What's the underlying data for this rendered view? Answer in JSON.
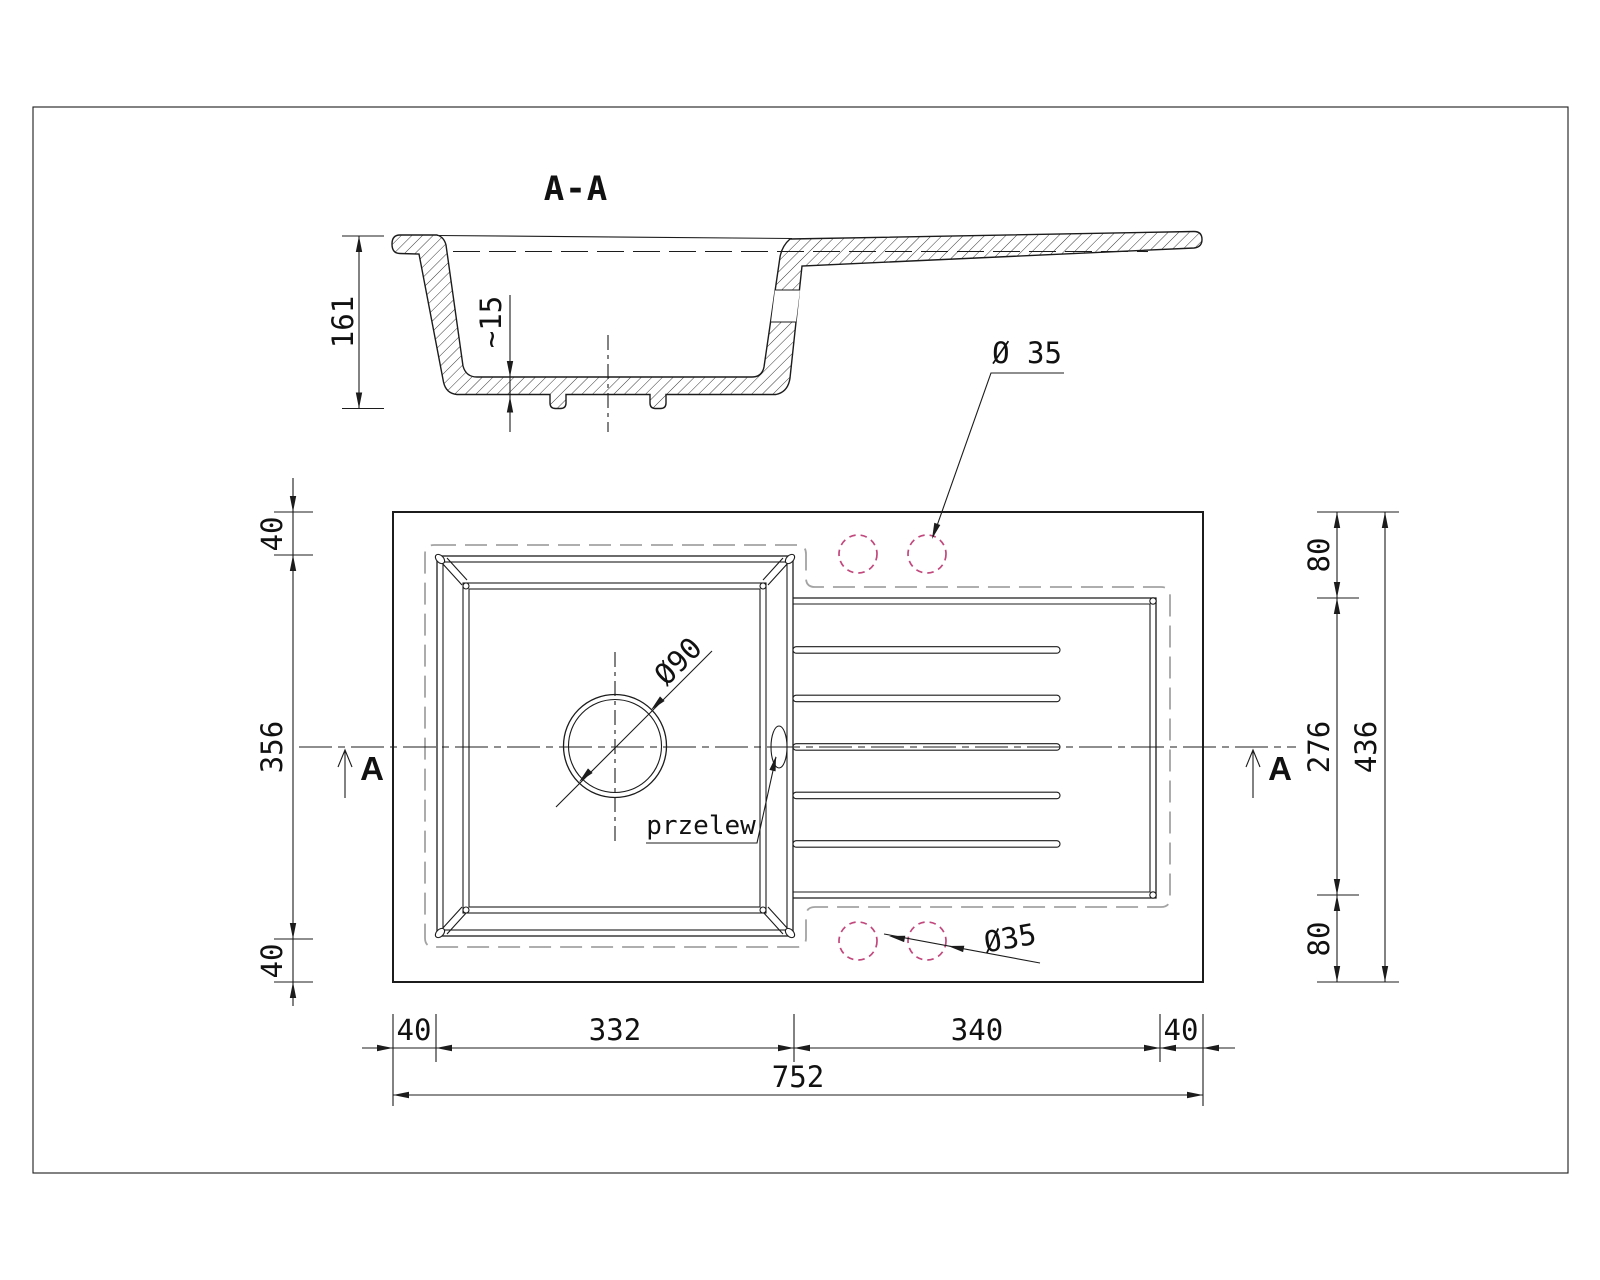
{
  "section": {
    "title": "A-A",
    "marker_label": "A",
    "dim_depth": "161",
    "dim_bottom_thickness": "~15"
  },
  "top_view": {
    "dim_left": [
      "40",
      "356",
      "40"
    ],
    "dim_right": [
      "80",
      "276",
      "80"
    ],
    "dim_right_total": "436",
    "dim_bottom": [
      "40",
      "332",
      "340",
      "40"
    ],
    "dim_bottom_total": "752",
    "drain_label": "Ø90",
    "overflow_label": "przelew",
    "tap_label_top": "Ø 35",
    "tap_label_bottom": "Ø35"
  },
  "colors": {
    "line": "#1c1c1c",
    "ghost": "#a3a3a3",
    "tap-hole": "#c2477c"
  }
}
